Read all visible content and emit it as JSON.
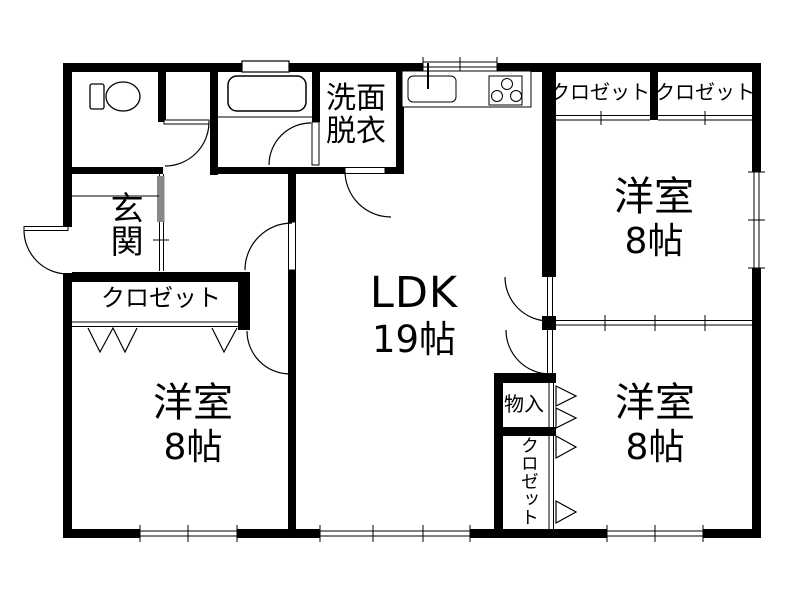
{
  "floorplan": {
    "entrance": {
      "label": "玄関"
    },
    "entrance_closet": {
      "label": "クロゼット"
    },
    "washroom": {
      "line1": "洗面",
      "line2": "脱衣"
    },
    "ldk": {
      "label": "LDK",
      "size": "19帖"
    },
    "room_top_right": {
      "label": "洋室",
      "size": "8帖"
    },
    "room_bottom_left": {
      "label": "洋室",
      "size": "8帖"
    },
    "room_bottom_right": {
      "label": "洋室",
      "size": "8帖"
    },
    "closet_top_right_left": {
      "label": "クロゼット"
    },
    "closet_top_right_right": {
      "label": "クロゼット"
    },
    "storage": {
      "label": "物入"
    },
    "closet_bottom_right": {
      "label": "クロゼット"
    },
    "colors": {
      "wall": "#000000",
      "background": "#ffffff",
      "sliding_panel": "#888888"
    }
  }
}
